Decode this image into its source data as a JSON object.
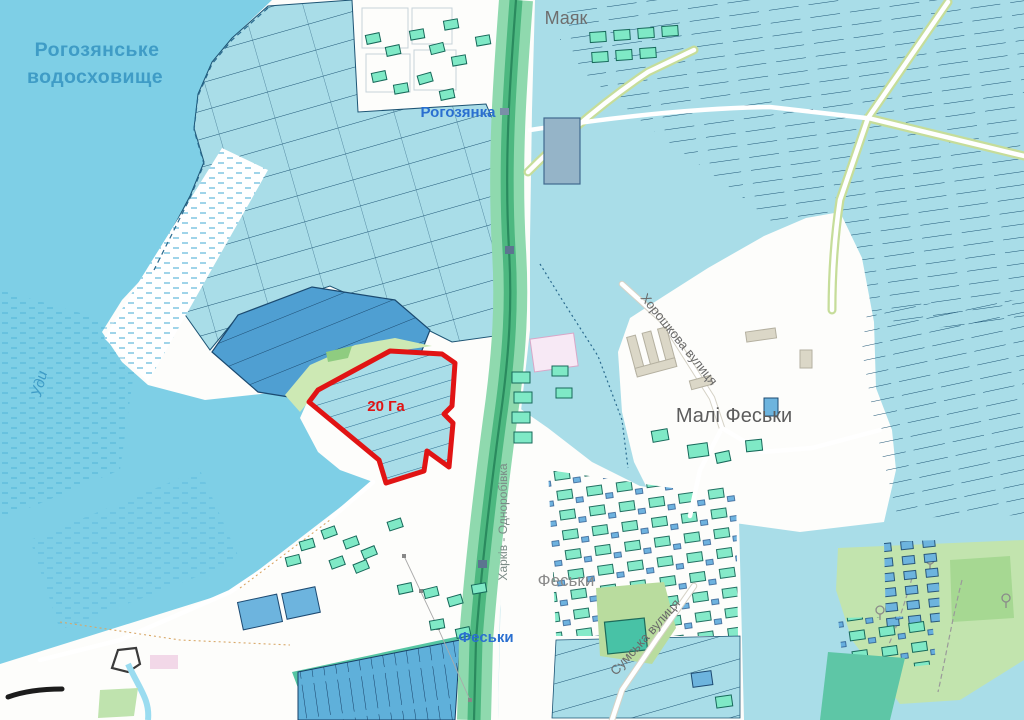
{
  "map": {
    "labels": {
      "reservoir_1": "Рогозянське",
      "reservoir_2": "водосховище",
      "river": "Уди",
      "mayak": "Маяк",
      "station_rohozianka": "Рогозянка",
      "street_khoroshkova": "Хорошкова вулиця",
      "village_mali_fesky": "Малі Феськи",
      "railway": "Харків - Одноробівка",
      "village_fesky": "Феськи",
      "station_fesky": "Феськи",
      "street_sumska": "Сумська вулиця",
      "selected_area": "20 Га"
    },
    "selected_parcel": {
      "area_label": "20 Га",
      "outline_color": "#e11414"
    },
    "colors": {
      "water": "#7ecfe6",
      "field_cyan": "#a9dde8",
      "field_dark": "#4f9fd2",
      "field_blue": "#5fb0da",
      "rail_green": "#8fd9ae",
      "rail_green_dark": "#4db880",
      "building_green": "#7fe9c6",
      "building_blue": "#6db4de",
      "highlight_red": "#e11414",
      "label_water_blue": "#3f9cc6",
      "label_station_blue": "#2a6fd0"
    }
  }
}
